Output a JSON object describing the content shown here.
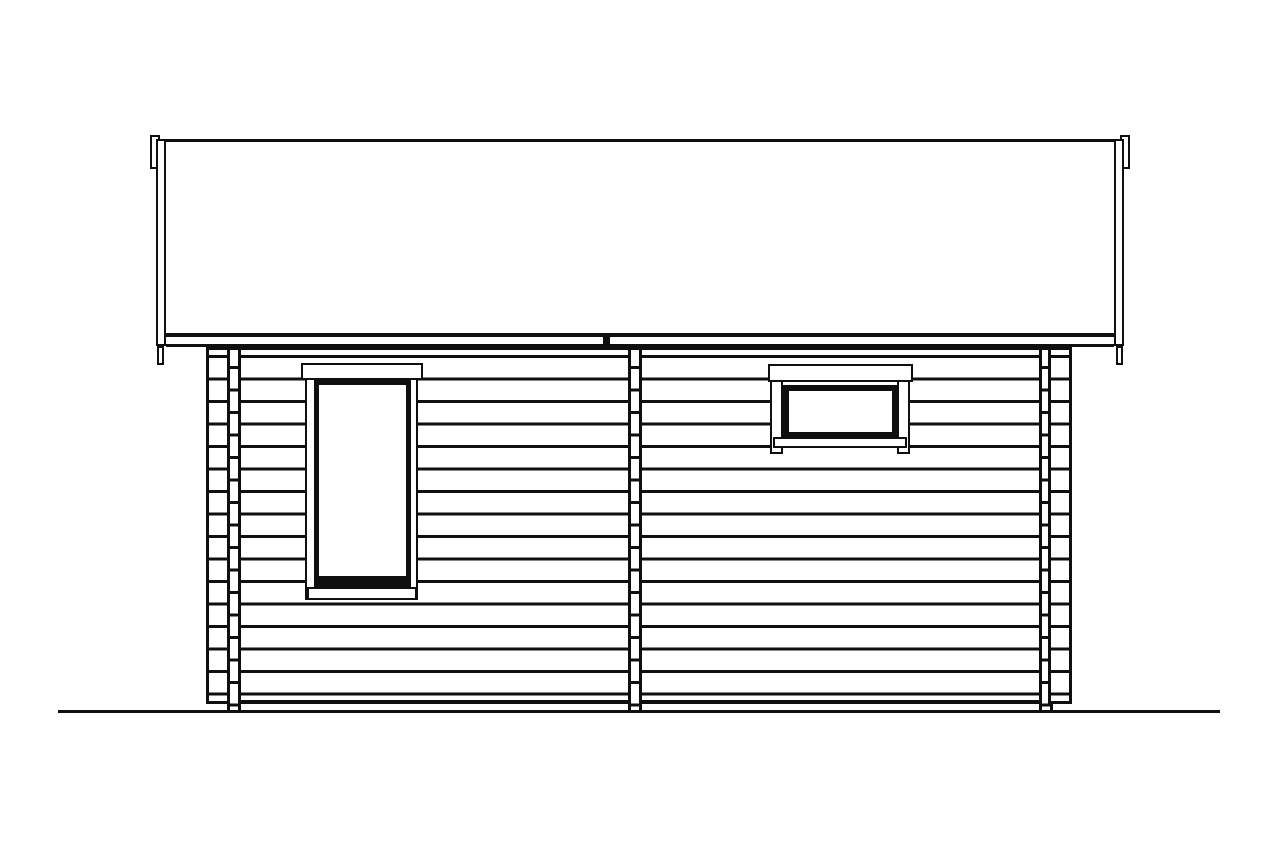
{
  "drawing": {
    "kind": "log-cabin-side-elevation-line-drawing",
    "colors": {
      "ink": "#0f0f0f",
      "paper": "#ffffff"
    },
    "roof": {
      "shape": "single large rectangle spanning full width with overhang on both sides",
      "edge_trim_boards": 2,
      "eave_edge_joint_tick": true
    },
    "walls": {
      "log_courses": 16,
      "course_height_px": 22.5,
      "sections": 2,
      "corner_log_end_columns": 4,
      "middle_cross_wall_log_end_column": 1
    },
    "windows": [
      {
        "id": "left-window",
        "orientation": "portrait",
        "panes": 1,
        "has_dark_bottom_rail": true
      },
      {
        "id": "right-window",
        "orientation": "landscape",
        "panes": 1,
        "has_dark_bottom_rail": false
      }
    ],
    "ground_line": true
  }
}
